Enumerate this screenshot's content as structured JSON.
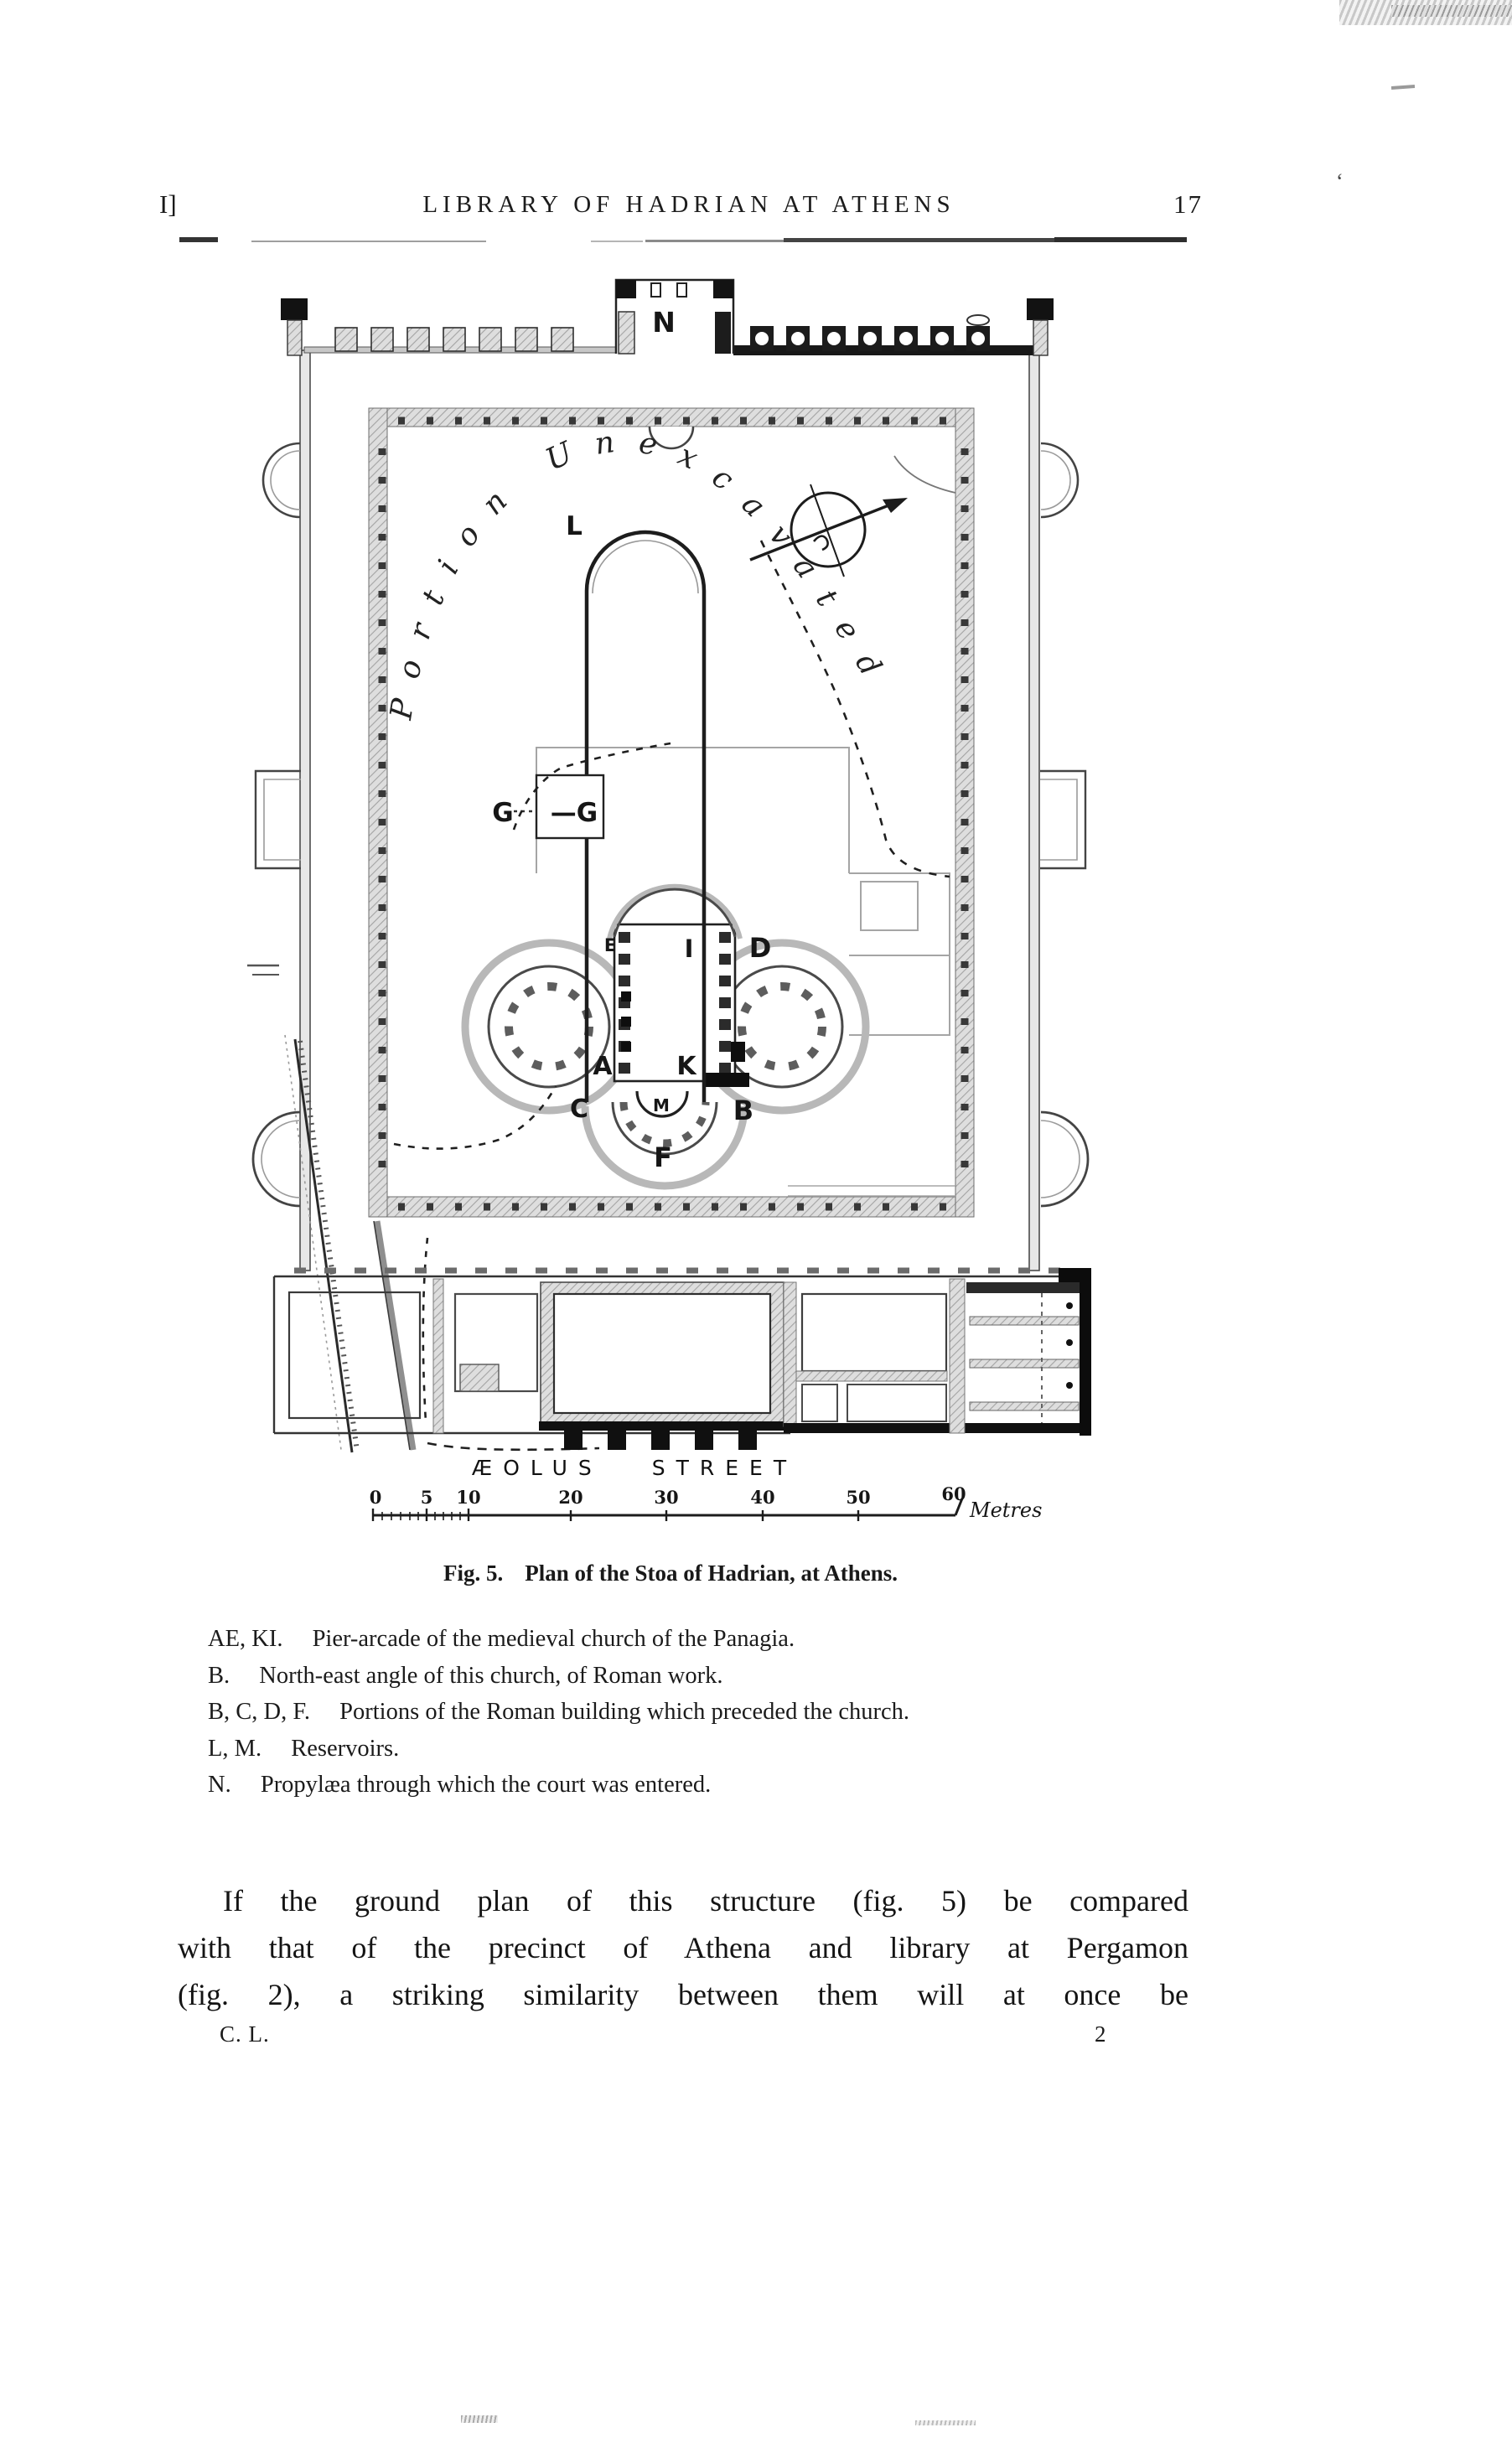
{
  "page": {
    "ink_color": "#1a1a1a",
    "header": {
      "section_marker": "I]",
      "title": "LIBRARY OF HADRIAN AT ATHENS",
      "page_number": "17",
      "stray_mark": "‘"
    },
    "figure": {
      "plan_labels": {
        "n": "N",
        "l": "L",
        "g_left": "G",
        "g_right": "—G",
        "e": "E",
        "i": "I",
        "d": "D",
        "a": "A",
        "k": "K",
        "c": "C",
        "m": "M",
        "b": "B",
        "f": "F"
      },
      "curved_note": "Portion Unexcavated",
      "street_label": "ÆOLUS STREET",
      "scale_bar": {
        "ticks": [
          "0",
          "5",
          "10",
          "20",
          "30",
          "40",
          "50",
          "60"
        ],
        "unit": "Metres"
      }
    },
    "caption": {
      "fig_label": "Fig. 5.",
      "text": "Plan of the Stoa of Hadrian, at Athens."
    },
    "legend": [
      {
        "key": "AE, KI.",
        "desc": "Pier-arcade of the medieval church of the Panagia."
      },
      {
        "key": "B.",
        "desc": "North-east angle of this church, of Roman work."
      },
      {
        "key": "B, C, D, F.",
        "desc": "Portions of the Roman building which preceded the church."
      },
      {
        "key": "L, M.",
        "desc": "Reservoirs."
      },
      {
        "key": "N.",
        "desc": "Propylæa through which the court was entered."
      }
    ],
    "body_lines": [
      "If the ground plan of this structure (fig. 5) be compared",
      "with that of the precinct of Athena and library at Pergamon",
      "(fig. 2), a striking similarity between them will at once be"
    ],
    "footer": {
      "signature": "C. L.",
      "page_indicator": "2"
    }
  }
}
